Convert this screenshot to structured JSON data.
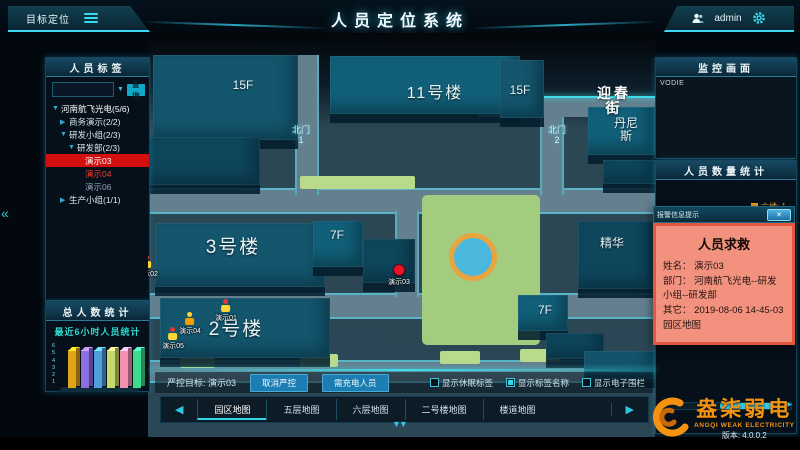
{
  "header": {
    "menu_left": "目标定位",
    "title": "人员定位系统",
    "user": "admin"
  },
  "left": {
    "tags_panel": {
      "title": "人员标签",
      "search_value": "",
      "search_button": "查询",
      "tree": [
        {
          "caret": "▼",
          "label": "河南航飞光电(5/6)",
          "indent": 0,
          "cls": "lv0"
        },
        {
          "caret": "▶",
          "label": "商务演示(2/2)",
          "indent": 1
        },
        {
          "caret": "▼",
          "label": "研发小组(2/3)",
          "indent": 1
        },
        {
          "caret": "▼",
          "label": "研发部(2/3)",
          "indent": 2
        },
        {
          "caret": "",
          "label": "演示03",
          "indent": 3,
          "cls": "sel"
        },
        {
          "caret": "",
          "label": "演示04",
          "indent": 3,
          "cls": "alert"
        },
        {
          "caret": "",
          "label": "演示06",
          "indent": 3,
          "cls": "dim"
        },
        {
          "caret": "▶",
          "label": "生产小组(1/1)",
          "indent": 1
        }
      ]
    },
    "total_panel": {
      "title": "总人数统计"
    }
  },
  "chart_data": {
    "type": "bar",
    "title": "最近6小时人员统计",
    "categories": [
      "",
      "",
      "",
      "",
      "",
      ""
    ],
    "values": [
      5,
      5,
      5,
      5,
      5,
      5
    ],
    "colors": [
      "#e0a417",
      "#8d6fe0",
      "#4f9fdc",
      "#c4dc6e",
      "#f48fb1",
      "#3edb8f"
    ],
    "ylim": [
      0,
      6
    ],
    "yticks": [
      "6",
      "5",
      "4",
      "3",
      "2",
      "1"
    ],
    "xlabel": "",
    "ylabel": ""
  },
  "map": {
    "labels": [
      {
        "text": "15F",
        "x": 95,
        "y": 46,
        "cls": "bl-md"
      },
      {
        "text": "11号楼",
        "x": 287,
        "y": 52,
        "cls": "bl-tw"
      },
      {
        "text": "15F",
        "x": 372,
        "y": 51,
        "cls": "bl-md"
      },
      {
        "text": "迎春街",
        "x": 466,
        "y": 53,
        "cls": "bl-street"
      },
      {
        "text": "丹尼斯",
        "x": 478,
        "y": 84,
        "cls": "bl-md"
      },
      {
        "text": "北门\n1",
        "x": 153,
        "y": 93,
        "cls": "bl-gate"
      },
      {
        "text": "北门\n2",
        "x": 409,
        "y": 93,
        "cls": "bl-gate"
      },
      {
        "text": "3号楼",
        "x": 85,
        "y": 205,
        "cls": "bl-lg"
      },
      {
        "text": "7F",
        "x": 189,
        "y": 196,
        "cls": "bl-md"
      },
      {
        "text": "2号楼",
        "x": 88,
        "y": 287,
        "cls": "bl-lg"
      },
      {
        "text": "7F",
        "x": 397,
        "y": 271,
        "cls": "bl-md"
      },
      {
        "text": "精华",
        "x": 464,
        "y": 204,
        "cls": "bl-md"
      }
    ],
    "markers": [
      {
        "label": "演示01",
        "type": "person",
        "c1": "#e53935",
        "c2": "#fdd835",
        "x": 78,
        "y": 266
      },
      {
        "label": "演示04",
        "type": "person",
        "c1": "#fdd835",
        "c2": "#f59f00",
        "x": 42,
        "y": 279
      },
      {
        "label": "演示05",
        "type": "person",
        "c1": "#e53935",
        "c2": "#fdd835",
        "x": 25,
        "y": 294
      },
      {
        "label": "演示02",
        "type": "person",
        "c1": "#e53935",
        "c2": "#fdd835",
        "x": -1,
        "y": 222
      },
      {
        "label": "演示03",
        "type": "dot",
        "x": 251,
        "y": 231
      }
    ],
    "controls": {
      "target_label": "严控目标: 演示03",
      "buttons": [
        {
          "label": "取消严控"
        },
        {
          "label": "需充电人员"
        }
      ],
      "checkboxes": [
        {
          "label": "显示休眠标签",
          "checked": false
        },
        {
          "label": "显示标签名称",
          "checked": true
        },
        {
          "label": "显示电子围栏",
          "checked": false
        }
      ]
    },
    "nav": {
      "prev": "◀",
      "next": "▶",
      "tabs": [
        {
          "label": "园区地图",
          "active": true
        },
        {
          "label": "五层地图",
          "active": false
        },
        {
          "label": "六层地图",
          "active": false
        },
        {
          "label": "二号楼地图",
          "active": false
        },
        {
          "label": "楼道地图",
          "active": false
        }
      ]
    }
  },
  "right": {
    "monitor_panel": {
      "title": "监控画面",
      "video_label": "VODIE"
    },
    "stats_panel": {
      "title": "人员数量统计",
      "legend": [
        {
          "label": "六楼: 1",
          "color": "#ffa726"
        }
      ]
    },
    "popup": {
      "titlebar": "报警信息提示",
      "close": "✕",
      "title": "人员求救",
      "rows": [
        {
          "k": "姓名：",
          "v": "演示03"
        },
        {
          "k": "部门：",
          "v": "河南航飞光电--研发小组--研发部"
        },
        {
          "k": "其它：",
          "v": "2019-08-06 14-45-03 园区地图"
        }
      ]
    }
  },
  "footer": {
    "brand": "盎柒弱电",
    "brand_en": "ANGQI WEAK ELECTRICITY",
    "version": "版本: 4.0.0.2"
  },
  "misc": {
    "collapse_left": "«",
    "handle_down": "▼▼"
  }
}
